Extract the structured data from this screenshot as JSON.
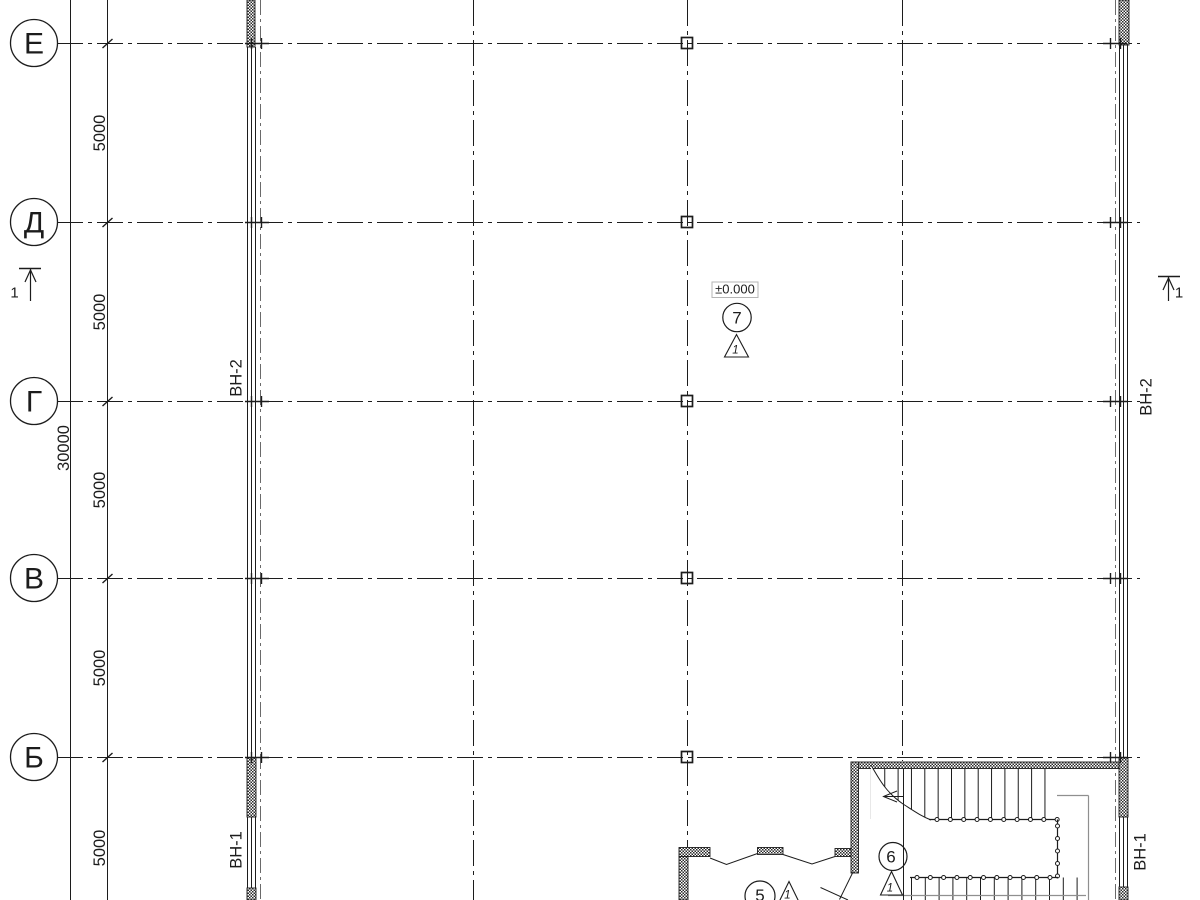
{
  "axes": {
    "rows": [
      {
        "label": "Е"
      },
      {
        "label": "Д"
      },
      {
        "label": "Г"
      },
      {
        "label": "В"
      },
      {
        "label": "Б"
      }
    ]
  },
  "dimensions": {
    "bays": [
      "5000",
      "5000",
      "5000",
      "5000",
      "5000"
    ],
    "total": "30000"
  },
  "wall_tags": {
    "left_upper": "ВН-2",
    "left_lower": "ВН-1",
    "right_upper": "ВН-2",
    "right_lower": "ВН-1"
  },
  "level_marker": {
    "value": "±0.000"
  },
  "nodes": {
    "hall": {
      "num": "7",
      "detail": "1"
    },
    "stair": {
      "num": "6",
      "detail": "1"
    },
    "entry": {
      "num": "5",
      "detail": "1"
    }
  },
  "section_marks": {
    "left": "1",
    "right": "1"
  },
  "colors": {
    "line": "#1c1c1c",
    "rail": "#8f8f8f",
    "level_box_border": "#b5b5b5"
  }
}
